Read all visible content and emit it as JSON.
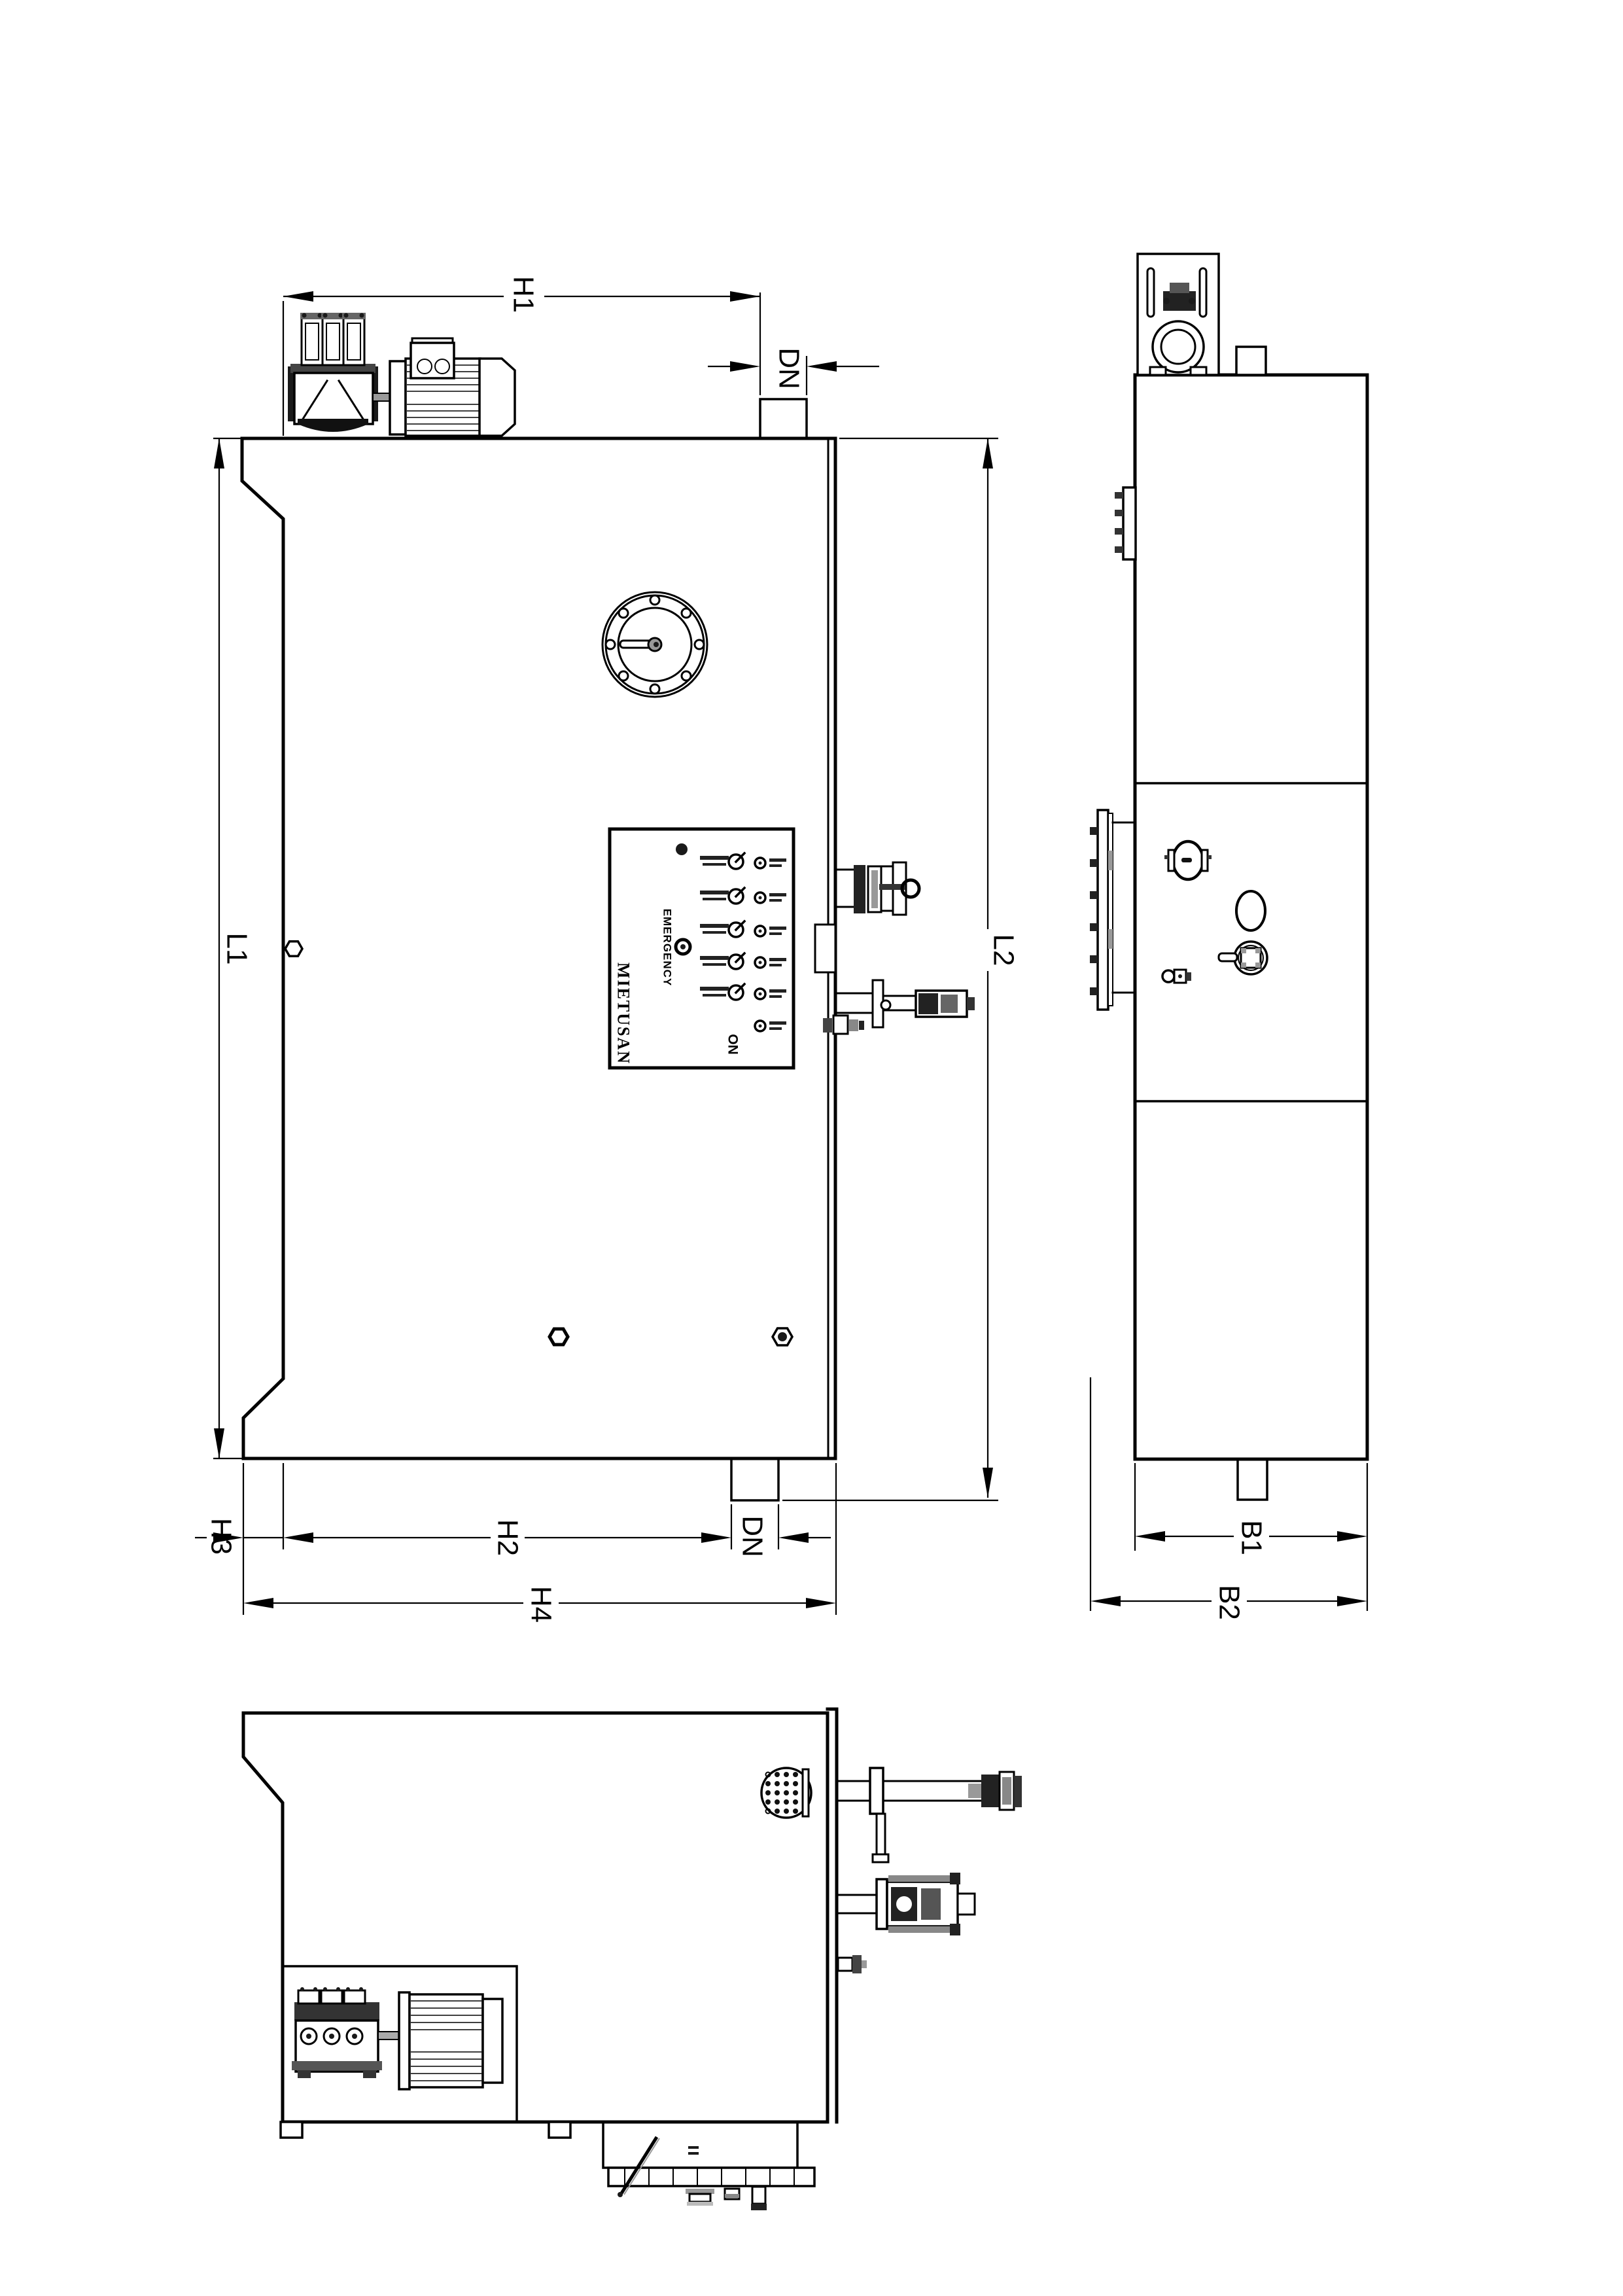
{
  "drawing": {
    "type": "steam-boiler dimensional drawing, rotated 90deg",
    "background": "#ffffff",
    "line_color": "#000000",
    "accent_gray": "#999999"
  },
  "labels": {
    "h1": "H1",
    "dn_top": "DN",
    "l1": "L1",
    "l2": "L2",
    "h3": "H3",
    "h2": "H2",
    "dn_bottom": "DN",
    "h4": "H4",
    "b1": "B1",
    "b2": "B2"
  },
  "control_panel": {
    "brand": "MIETUSAN",
    "emergency_label": "EMERGENCY",
    "on_label": "ON",
    "switch_count": 5,
    "indicator_count": 6
  }
}
